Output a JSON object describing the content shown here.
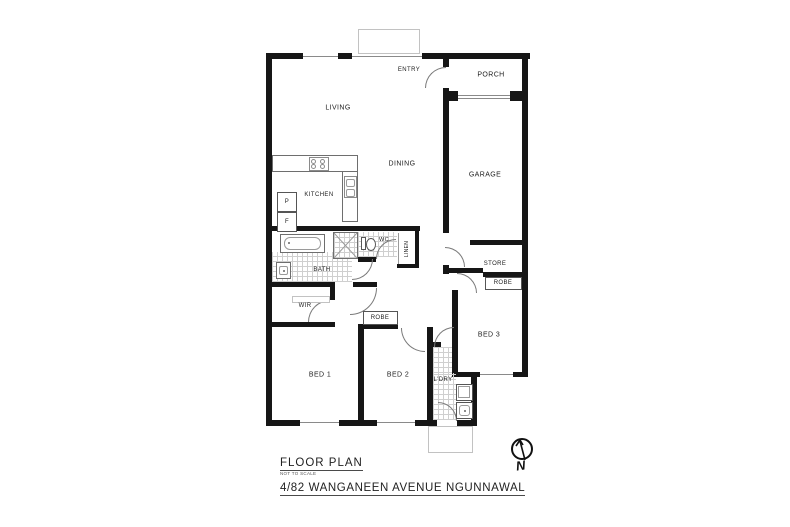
{
  "footer": {
    "title": "FLOOR PLAN",
    "scale_note": "NOT TO SCALE",
    "address": "4/82 WANGANEEN AVENUE NGUNNAWAL"
  },
  "compass": {
    "north_label": "N"
  },
  "rooms": {
    "living": "LIVING",
    "dining": "DINING",
    "kitchen": "KITCHEN",
    "entry": "ENTRY",
    "porch": "PORCH",
    "garage": "GARAGE",
    "wc": "WC",
    "linen": "LINEN",
    "bath": "BATH",
    "wir": "WIR",
    "store": "STORE",
    "robe_bed3": "ROBE",
    "robe_bed2": "ROBE",
    "bed1": "BED 1",
    "bed2": "BED 2",
    "bed3": "BED 3",
    "laundry": "L'DRY"
  },
  "fixtures": {
    "pantry": "P",
    "fridge": "F"
  },
  "colors": {
    "wall": "#161616",
    "thin_line": "#6e6e6e",
    "hatch": "#cfcfcf",
    "background": "#ffffff"
  }
}
